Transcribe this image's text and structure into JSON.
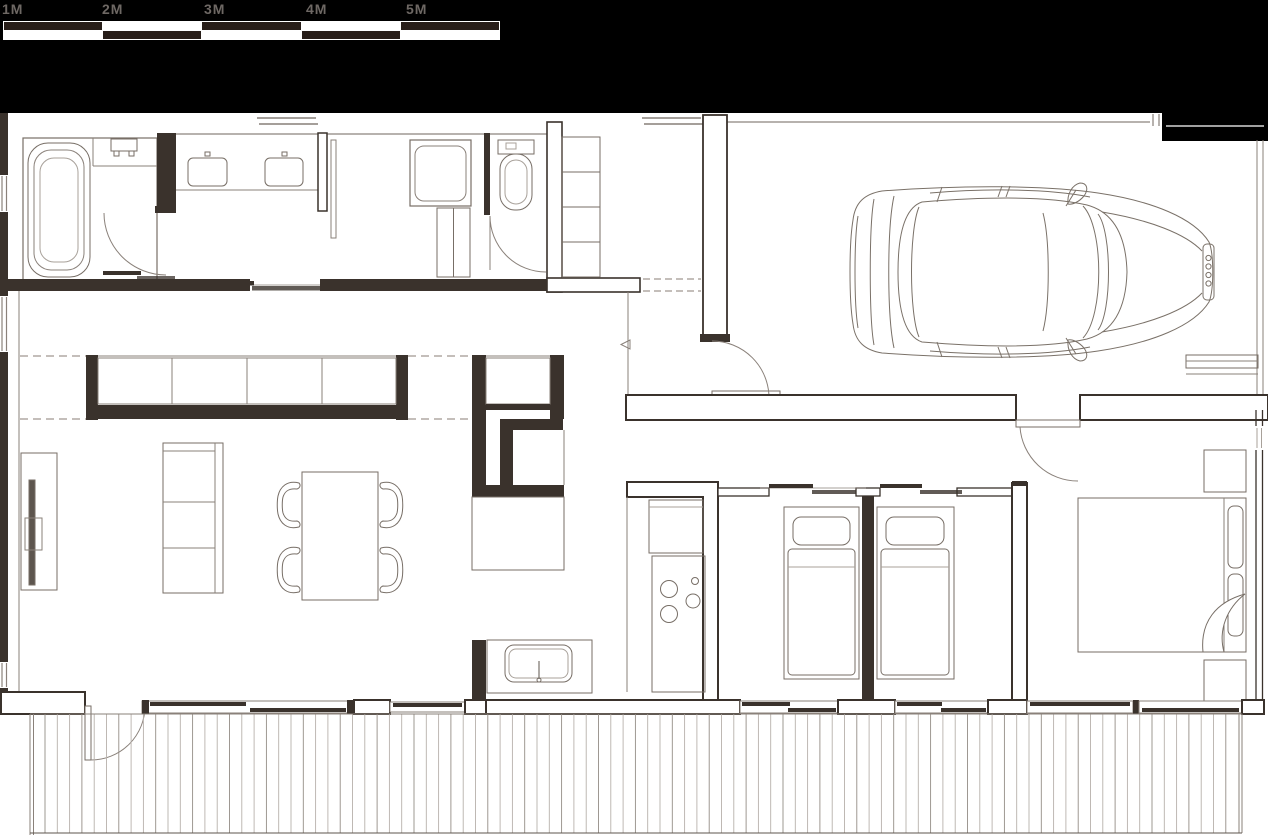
{
  "scale_bar": {
    "labels": [
      "1M",
      "2M",
      "3M",
      "4M",
      "5M"
    ],
    "meters": 5
  },
  "colors": {
    "background": "#000000",
    "paper": "#ffffff",
    "wall_line": "#3a322c",
    "furniture_line": "#776e66",
    "light_line": "#a8a19a",
    "scale_dark": "#281e19",
    "scale_label": "#6e6864"
  },
  "floor_plan": {
    "furniture_icons": [
      "bathtub",
      "shower-mixer",
      "vanity-sink",
      "washing-machine",
      "laundry-cabinet",
      "toilet",
      "shoe-shelf",
      "entry-step-arrow",
      "tv-board",
      "sofa",
      "dining-table",
      "dining-chair",
      "window-bench",
      "kitchen-island",
      "kitchen-sink",
      "refrigerator",
      "cooktop",
      "single-bed",
      "double-bed",
      "nightstand",
      "car",
      "wood-deck",
      "swing-door",
      "sliding-door",
      "window"
    ]
  }
}
